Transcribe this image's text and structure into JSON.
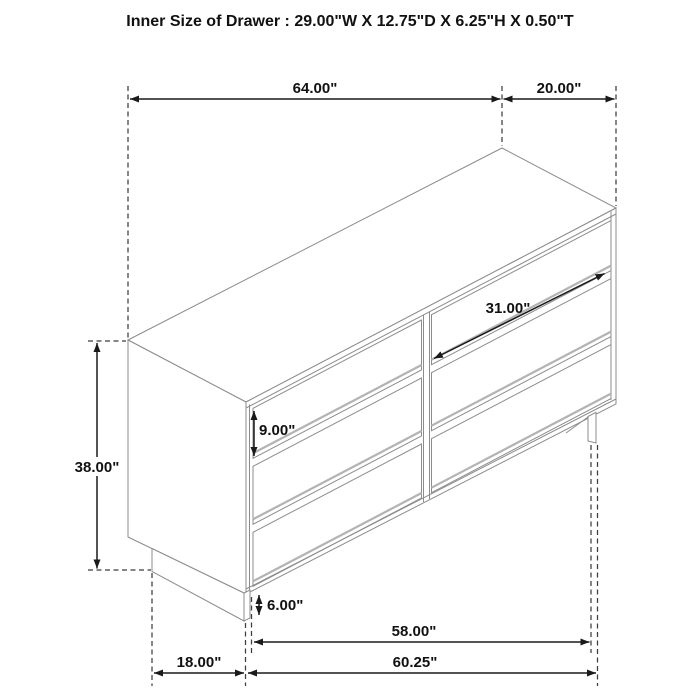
{
  "title": "Inner Size of Drawer : 29.00\"W X 12.75\"D X 6.25\"H X 0.50\"T",
  "dims": {
    "top_width": {
      "label": "64.00\""
    },
    "top_depth": {
      "label": "20.00\""
    },
    "height": {
      "label": "38.00\""
    },
    "drawer_width": {
      "label": "31.00\""
    },
    "drawer_height": {
      "label": "9.00\""
    },
    "base_height": {
      "label": "6.00\""
    },
    "inner_width": {
      "label": "58.00\""
    },
    "base_width": {
      "label": "60.25\""
    },
    "base_depth": {
      "label": "18.00\""
    }
  }
}
